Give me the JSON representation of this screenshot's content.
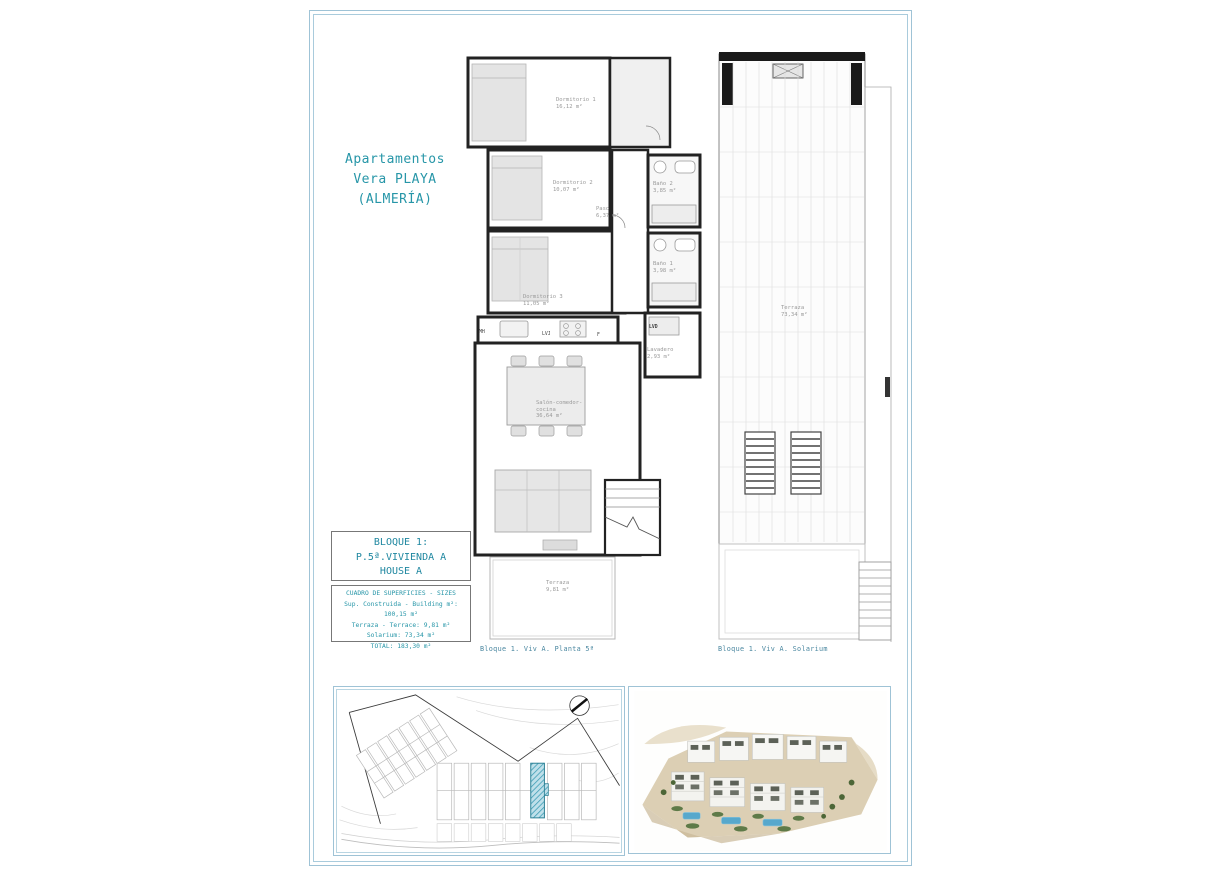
{
  "document": {
    "title_lines": [
      "Apartamentos",
      "Vera PLAYA",
      "(ALMERÍA)"
    ],
    "block_box": {
      "line1": "BLOQUE 1:",
      "line2": "P.5ª.VIVIENDA A",
      "line3": "HOUSE A"
    },
    "sizes_box": {
      "header": "CUADRO DE SUPERFICIES  - SIZES",
      "rows": [
        "Sup. Construida  - Building m²:  100,15 m²",
        "Terraza  - Terrace:  9,81 m²",
        "Solarium:  73,34 m²",
        "TOTAL:  183,30 m²"
      ]
    },
    "captions": {
      "planta": "Bloque 1. Viv A. Planta 5ª",
      "solarium": "Bloque 1. Viv A. Solarium"
    }
  },
  "floor_plan": {
    "rooms": [
      {
        "name": "Dormitorio 1",
        "area": "16,12 m²"
      },
      {
        "name": "Dormitorio 2",
        "area": "10,07 m²"
      },
      {
        "name": "Baño 2",
        "area": "3,85 m²"
      },
      {
        "name": "Paso",
        "area": "6,37 m²"
      },
      {
        "name": "Baño 1",
        "area": "3,98 m²"
      },
      {
        "name": "Dormitorio 3",
        "area": "11,05 m²"
      },
      {
        "name": "Lavadero",
        "area": "2,93 m²"
      },
      {
        "name": "Salón-comedor-cocina",
        "area": "36,64 m²"
      },
      {
        "name": "Terraza",
        "area": "9,81 m²"
      }
    ],
    "appliance_labels": {
      "mh": "MH",
      "lvj": "LVJ",
      "f": "F",
      "lvd": "LVD"
    }
  },
  "solarium_plan": {
    "room": {
      "name": "Terraza",
      "area": "73,34 m²"
    }
  },
  "colors": {
    "accent_teal": "#2796a8",
    "frame_blue": "#9fc3d6",
    "plot_highlight": "#49a5bd"
  }
}
